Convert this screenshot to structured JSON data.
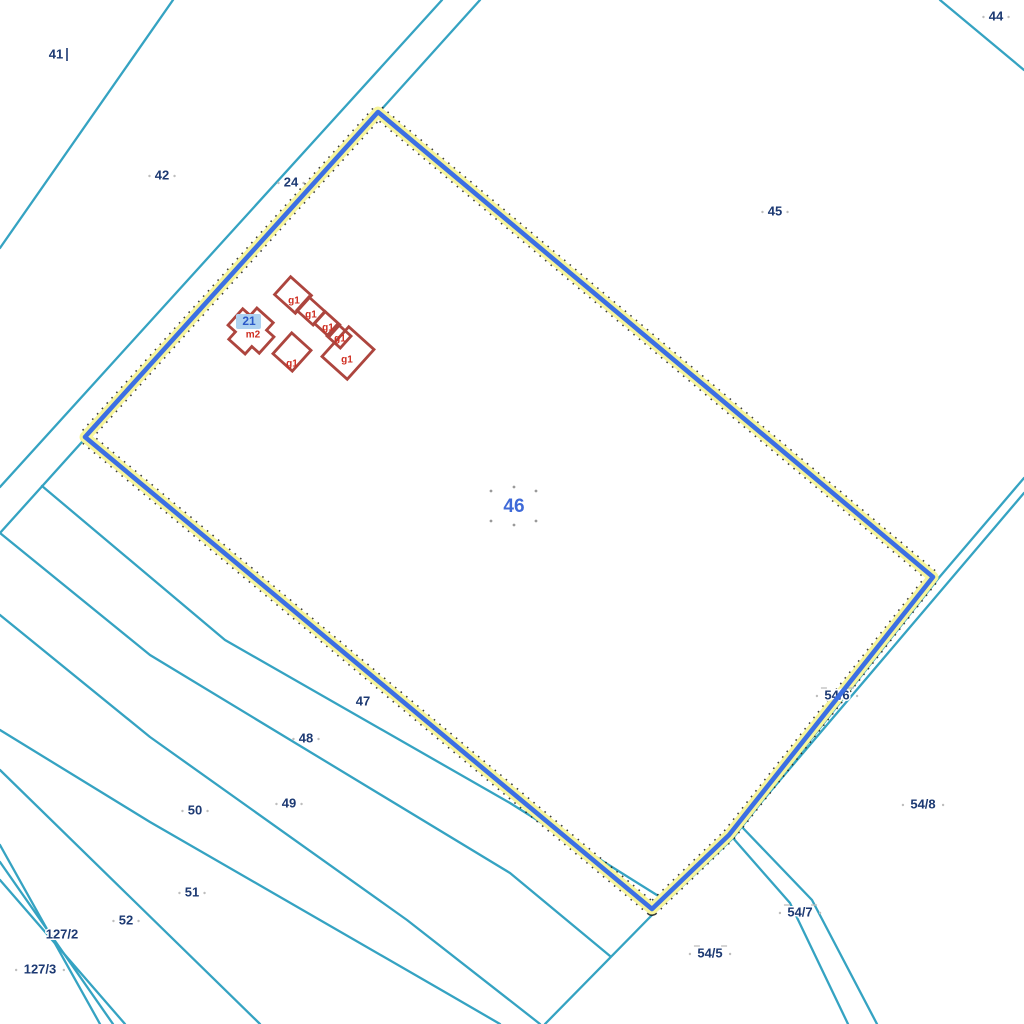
{
  "map": {
    "type": "cadastral-parcel-map",
    "background": "#ffffff",
    "colors": {
      "boundary_teal": "#35a3c2",
      "highlight_blue": "#3c6fe3",
      "highlight_halo_yellow": "#f7f59c",
      "highlight_dot_black": "#1a1a1a",
      "label_navy": "#1d3a73",
      "label_halo": "#ffffff",
      "building_red": "#ad453e",
      "building_label_red": "#cf2e21",
      "selected_parcel_blue": "#3f6ad8",
      "selected_building_text": "#2b59c8",
      "selected_building_bg": "#aed2f0",
      "tick_gray": "#bdbdbd"
    },
    "selected_parcel": {
      "label": "46",
      "label_x": 514,
      "label_y": 507,
      "label_size": 19,
      "outline_points": "378,112 933,577 729,835 652,909 85,437",
      "handle_dots": [
        [
          491,
          491
        ],
        [
          536,
          491
        ],
        [
          514,
          487
        ],
        [
          491,
          521
        ],
        [
          536,
          521
        ],
        [
          514,
          525
        ]
      ]
    },
    "boundary_lines": [
      {
        "name": "parcel-41-42-boundary",
        "points": "173,0 0,248"
      },
      {
        "name": "parcel-42-24-boundary",
        "points": "442,0 0,487"
      },
      {
        "name": "parcel-24-46-boundary",
        "points": "480,0 0,533"
      },
      {
        "name": "parcel-44-45-boundary",
        "points": "940,0 1024,70"
      },
      {
        "name": "road-54-6-inner-boundary",
        "points": "1024,478 937,580 733,838 655,912 545,1024"
      },
      {
        "name": "road-54-6-outer-boundary",
        "points": "1024,493 741,826 812,900 877,1024"
      },
      {
        "name": "corridor-54-7-left-boundary",
        "points": "733,838 790,903 848,1024"
      },
      {
        "name": "strip-47-48-boundary",
        "points": "42,486 225,640 510,803 660,897"
      },
      {
        "name": "strip-48-49-boundary",
        "points": "0,533 150,655 510,873 610,956"
      },
      {
        "name": "strip-49-50-boundary",
        "points": "0,615 150,737 407,920 540,1024"
      },
      {
        "name": "strip-50-51-boundary",
        "points": "0,730 150,822 450,995 500,1024"
      },
      {
        "name": "strip-51-52-boundary",
        "points": "0,770 260,1024"
      },
      {
        "name": "strip-127-boundary-1",
        "points": "0,845 100,1024"
      },
      {
        "name": "strip-127-boundary-2",
        "points": "0,862 113,1024"
      },
      {
        "name": "strip-127-boundary-3",
        "points": "0,880 125,1024"
      }
    ],
    "parcel_labels": [
      {
        "text": "41",
        "x": 56,
        "y": 55,
        "sidedots": false
      },
      {
        "text": "42",
        "x": 162,
        "y": 176,
        "sidedots": true
      },
      {
        "text": "24",
        "x": 291,
        "y": 183,
        "sidedots": true
      },
      {
        "text": "44",
        "x": 996,
        "y": 17,
        "sidedots": true
      },
      {
        "text": "45",
        "x": 775,
        "y": 212,
        "sidedots": true
      },
      {
        "text": "47",
        "x": 363,
        "y": 702,
        "sidedots": false
      },
      {
        "text": "48",
        "x": 306,
        "y": 739,
        "sidedots": true
      },
      {
        "text": "49",
        "x": 289,
        "y": 804,
        "sidedots": true
      },
      {
        "text": "50",
        "x": 195,
        "y": 811,
        "sidedots": true
      },
      {
        "text": "51",
        "x": 192,
        "y": 893,
        "sidedots": true
      },
      {
        "text": "52",
        "x": 126,
        "y": 921,
        "sidedots": true
      },
      {
        "text": "127/2",
        "x": 62,
        "y": 935,
        "sidedots": false
      },
      {
        "text": "127/3",
        "x": 40,
        "y": 970,
        "sidedots": true
      },
      {
        "text": "54/5",
        "x": 710,
        "y": 954,
        "sidedots": true,
        "overbar": true
      },
      {
        "text": "54/7",
        "x": 800,
        "y": 913,
        "sidedots": true,
        "overbar": true
      },
      {
        "text": "54/8",
        "x": 923,
        "y": 805,
        "sidedots": true
      }
    ],
    "road_label_under_highlight": {
      "text": "54/6",
      "x": 837,
      "y": 696,
      "sidedots": true,
      "overbar": true
    },
    "label_tick": {
      "x": 67,
      "y1": 48,
      "y2": 61
    },
    "buildings": [
      {
        "name": "farm-house-m2",
        "cx": 251,
        "cy": 331,
        "angle": 42,
        "points": "-21,-11 -11,-11 -11,-21 11,-21 11,-11 21,-11 21,11 11,11 11,21 -11,21 -11,11 -21,11"
      },
      {
        "name": "outbuilding-row-1",
        "cx": 293,
        "cy": 295,
        "angle": 42,
        "points": "-14,-12 14,-12 14,12 -14,12"
      },
      {
        "name": "outbuilding-row-2",
        "cx": 311,
        "cy": 311,
        "angle": 42,
        "points": "-11,-9 11,-9 11,9 -11,9"
      },
      {
        "name": "outbuilding-row-3",
        "cx": 327,
        "cy": 324,
        "angle": 42,
        "points": "-10,-8 10,-8 10,8 -10,8"
      },
      {
        "name": "outbuilding-row-4",
        "cx": 339,
        "cy": 336,
        "angle": 42,
        "points": "-9,-8 9,-8 9,8 -9,8"
      },
      {
        "name": "outbuilding-large",
        "cx": 348,
        "cy": 353,
        "angle": 42,
        "points": "-17,-20 17,-20 17,20 -17,20"
      },
      {
        "name": "shed",
        "cx": 292,
        "cy": 352,
        "angle": 42,
        "points": "-13,-14 13,-14 13,14 -13,14"
      }
    ],
    "building_labels": [
      {
        "text": "g1",
        "x": 294,
        "y": 301
      },
      {
        "text": "g1",
        "x": 311,
        "y": 315
      },
      {
        "text": "g1",
        "x": 328,
        "y": 328
      },
      {
        "text": "g1",
        "x": 340,
        "y": 339
      },
      {
        "text": "g1",
        "x": 347,
        "y": 360
      },
      {
        "text": "g1",
        "x": 292,
        "y": 364
      },
      {
        "text": "m2",
        "x": 253,
        "y": 335
      }
    ],
    "selected_building_label": {
      "text": "21",
      "x": 249,
      "y": 322,
      "bg_x": 236,
      "bg_y": 314,
      "bg_w": 25,
      "bg_h": 15
    }
  }
}
